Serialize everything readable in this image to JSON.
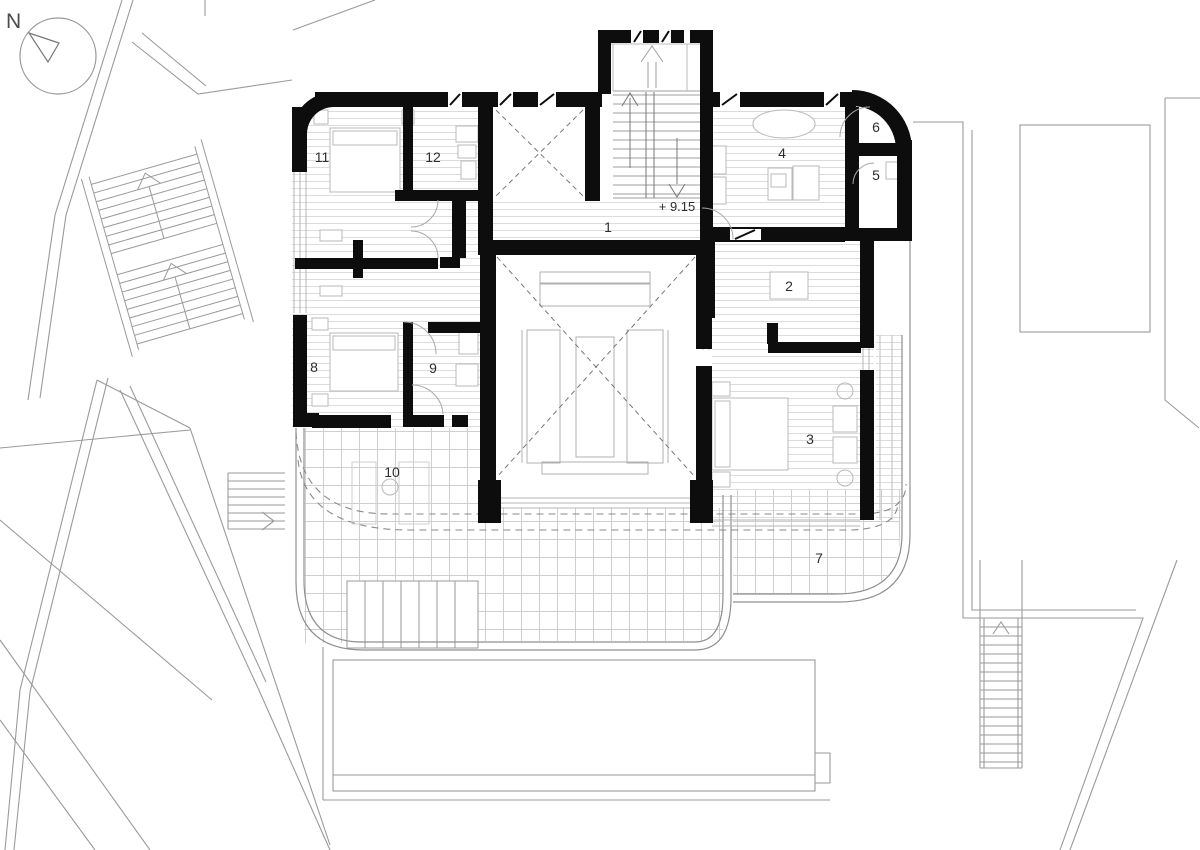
{
  "compass": {
    "label": "N"
  },
  "annotations": {
    "level": "+ 9.15"
  },
  "rooms": [
    {
      "id": "room-1",
      "number": "1"
    },
    {
      "id": "room-2",
      "number": "2"
    },
    {
      "id": "room-3",
      "number": "3"
    },
    {
      "id": "room-4",
      "number": "4"
    },
    {
      "id": "room-5",
      "number": "5"
    },
    {
      "id": "room-6",
      "number": "6"
    },
    {
      "id": "room-7",
      "number": "7"
    },
    {
      "id": "room-8",
      "number": "8"
    },
    {
      "id": "room-9",
      "number": "9"
    },
    {
      "id": "room-10",
      "number": "10"
    },
    {
      "id": "room-11",
      "number": "11"
    },
    {
      "id": "room-12",
      "number": "12"
    }
  ],
  "colors": {
    "wall": "#0d0d0d",
    "site_line": "#9a9a9a",
    "parapet_line": "#8f8f8f",
    "floor_line": "#dcdcdc",
    "tile_line": "#cfcfcf",
    "furniture_line": "#b8b8b8",
    "dashed_overhang": "#8a8a8a",
    "void_dash": "#777777",
    "label_text": "#2e2e2e"
  }
}
